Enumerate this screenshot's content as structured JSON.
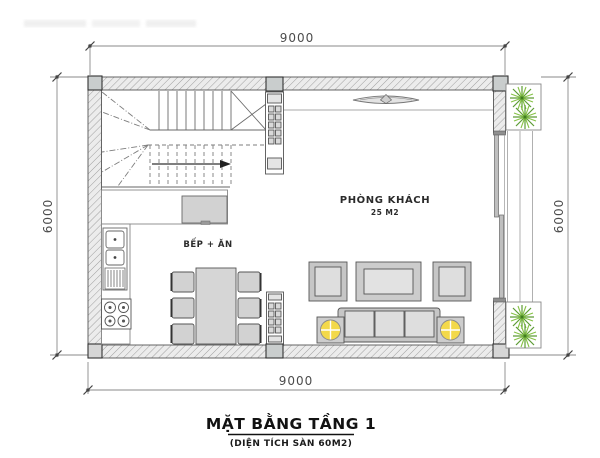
{
  "title": {
    "main": "MẶT BẰNG TẦNG 1",
    "subtitle": "(DIỆN TÍCH SÀN 60M2)"
  },
  "rooms": {
    "living_room": {
      "label": "PHÒNG KHÁCH",
      "area_label": "25 M2"
    },
    "kitchen_dining": {
      "label": "BẾP + ĂN"
    }
  },
  "dimensions": {
    "top": "9000",
    "bottom": "9000",
    "left": "6000",
    "right": "6000"
  },
  "icons": {
    "plants": "plant-icon",
    "ceiling_light": "ceiling-light-icon",
    "table_lamps": "lamp-icon",
    "stair_direction": "stair-arrow-icon"
  },
  "colors": {
    "wall_fill": "#ececec",
    "wall_hatch": "#9f9f9f",
    "column_fill": "#c9cdcd",
    "furniture_frame": "#c6c6c6",
    "furniture_cushion": "#dedede",
    "lamp_yellow": "#f3d94a",
    "plant_green": "#5d9c34",
    "plant_green_light": "#86c245",
    "dimension_gray": "#4c4c4c",
    "title_black": "#121212"
  }
}
